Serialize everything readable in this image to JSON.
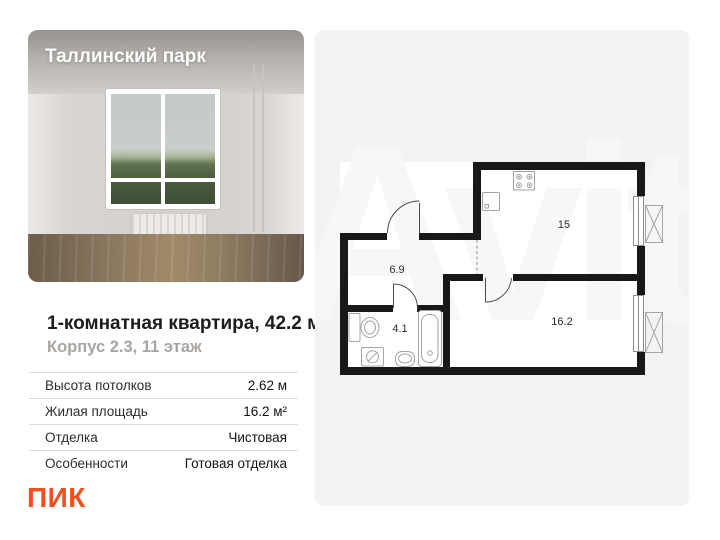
{
  "photo": {
    "overlay_title": "Таллинский парк"
  },
  "listing": {
    "title": "1-комнатная квартира, 42.2 м²",
    "subtitle": "Корпус 2.3, 11 этаж"
  },
  "specs": {
    "rows": [
      {
        "label": "Высота потолков",
        "value": "2.62 м"
      },
      {
        "label": "Жилая площадь",
        "value": "16.2 м²"
      },
      {
        "label": "Отделка",
        "value": "Чистовая"
      },
      {
        "label": "Особенности",
        "value": "Готовая отделка"
      }
    ]
  },
  "developer": {
    "name": "ПИК",
    "brand_color": "#F0501E"
  },
  "floor_plan": {
    "rooms": [
      {
        "name": "kitchen-living-room",
        "area_label": "15"
      },
      {
        "name": "hallway",
        "area_label": "6.9"
      },
      {
        "name": "bathroom",
        "area_label": "4.1"
      },
      {
        "name": "bedroom",
        "area_label": "16.2"
      }
    ]
  },
  "watermark": {
    "text": "Avito"
  },
  "colors": {
    "panel_bg": "#f4f3f1",
    "wall": "#181818",
    "accent": "#F0501E"
  }
}
